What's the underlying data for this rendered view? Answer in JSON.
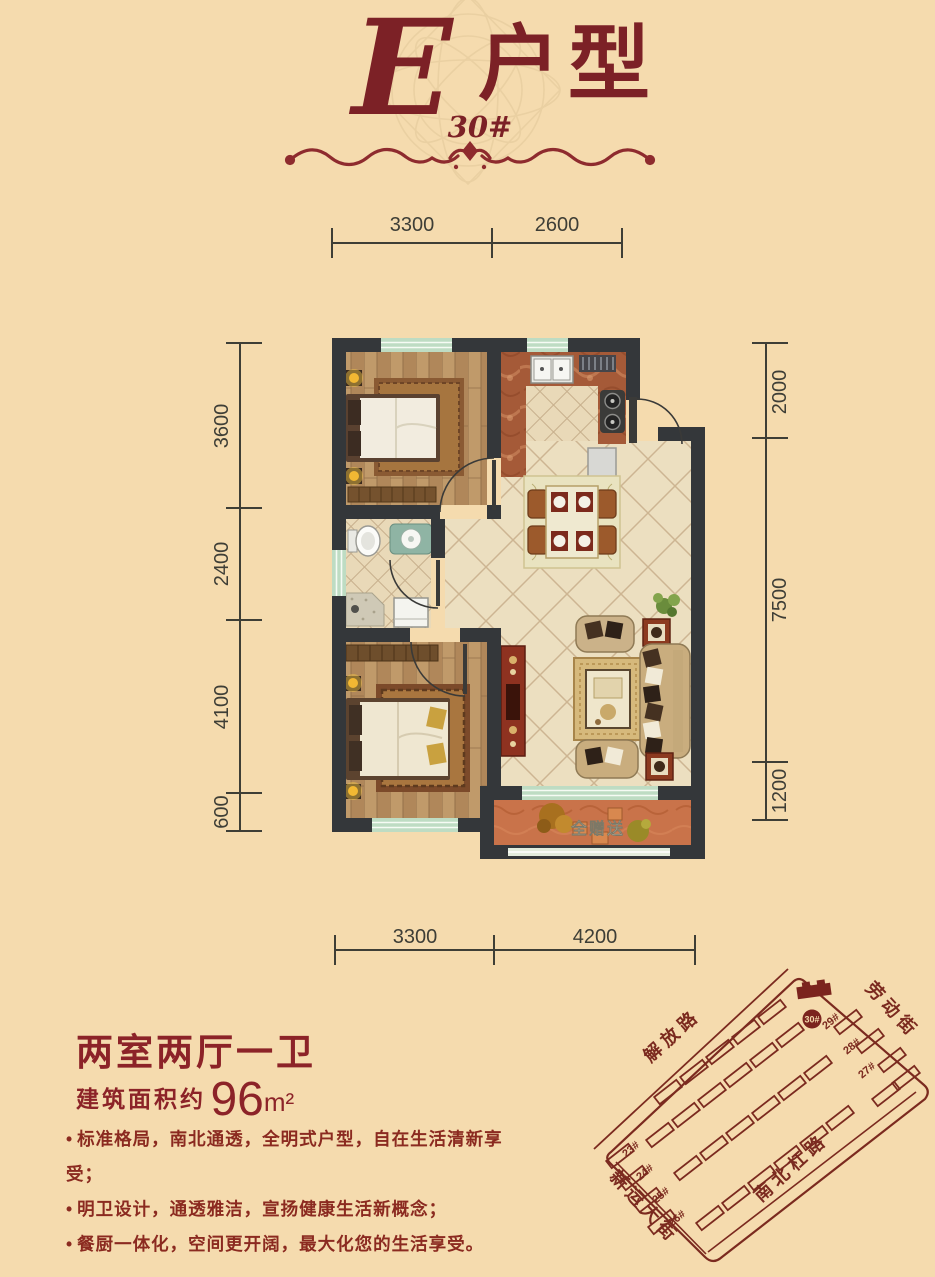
{
  "colors": {
    "accent": "#7c2126",
    "background": "#f5dbae",
    "wall": "#34373a",
    "window_green": "#bedcc3",
    "map_line": "#7b2a1f",
    "balcony_floor": "#c9734a"
  },
  "header": {
    "letter": "E",
    "title": "户型",
    "building_no": "30#"
  },
  "plan": {
    "balcony_label": "全赠送",
    "dims": {
      "top": [
        "3300",
        "2600"
      ],
      "bottom": [
        "3300",
        "4200"
      ],
      "left": [
        "3600",
        "2400",
        "4100",
        "600"
      ],
      "right": [
        "2000",
        "7500",
        "1200"
      ]
    }
  },
  "info": {
    "layout_title": "两室两厅一卫",
    "area_prefix": "建筑面积约",
    "area_value": "96",
    "area_unit": "m²",
    "features": [
      "标准格局，南北通透，全明式户型，自在生活清新享受；",
      "明卫设计，通透雅洁，宣扬健康生活新概念；",
      "餐厨一体化，空间更开阔，最大化您的生活享受。"
    ]
  },
  "sitemap": {
    "streets": [
      "解放路",
      "劳动街",
      "南北杠路",
      "新运大街"
    ],
    "highlight": "30#",
    "building_labels": [
      "29#",
      "28#",
      "27#",
      "23#",
      "24#",
      "25#",
      "26#"
    ]
  }
}
